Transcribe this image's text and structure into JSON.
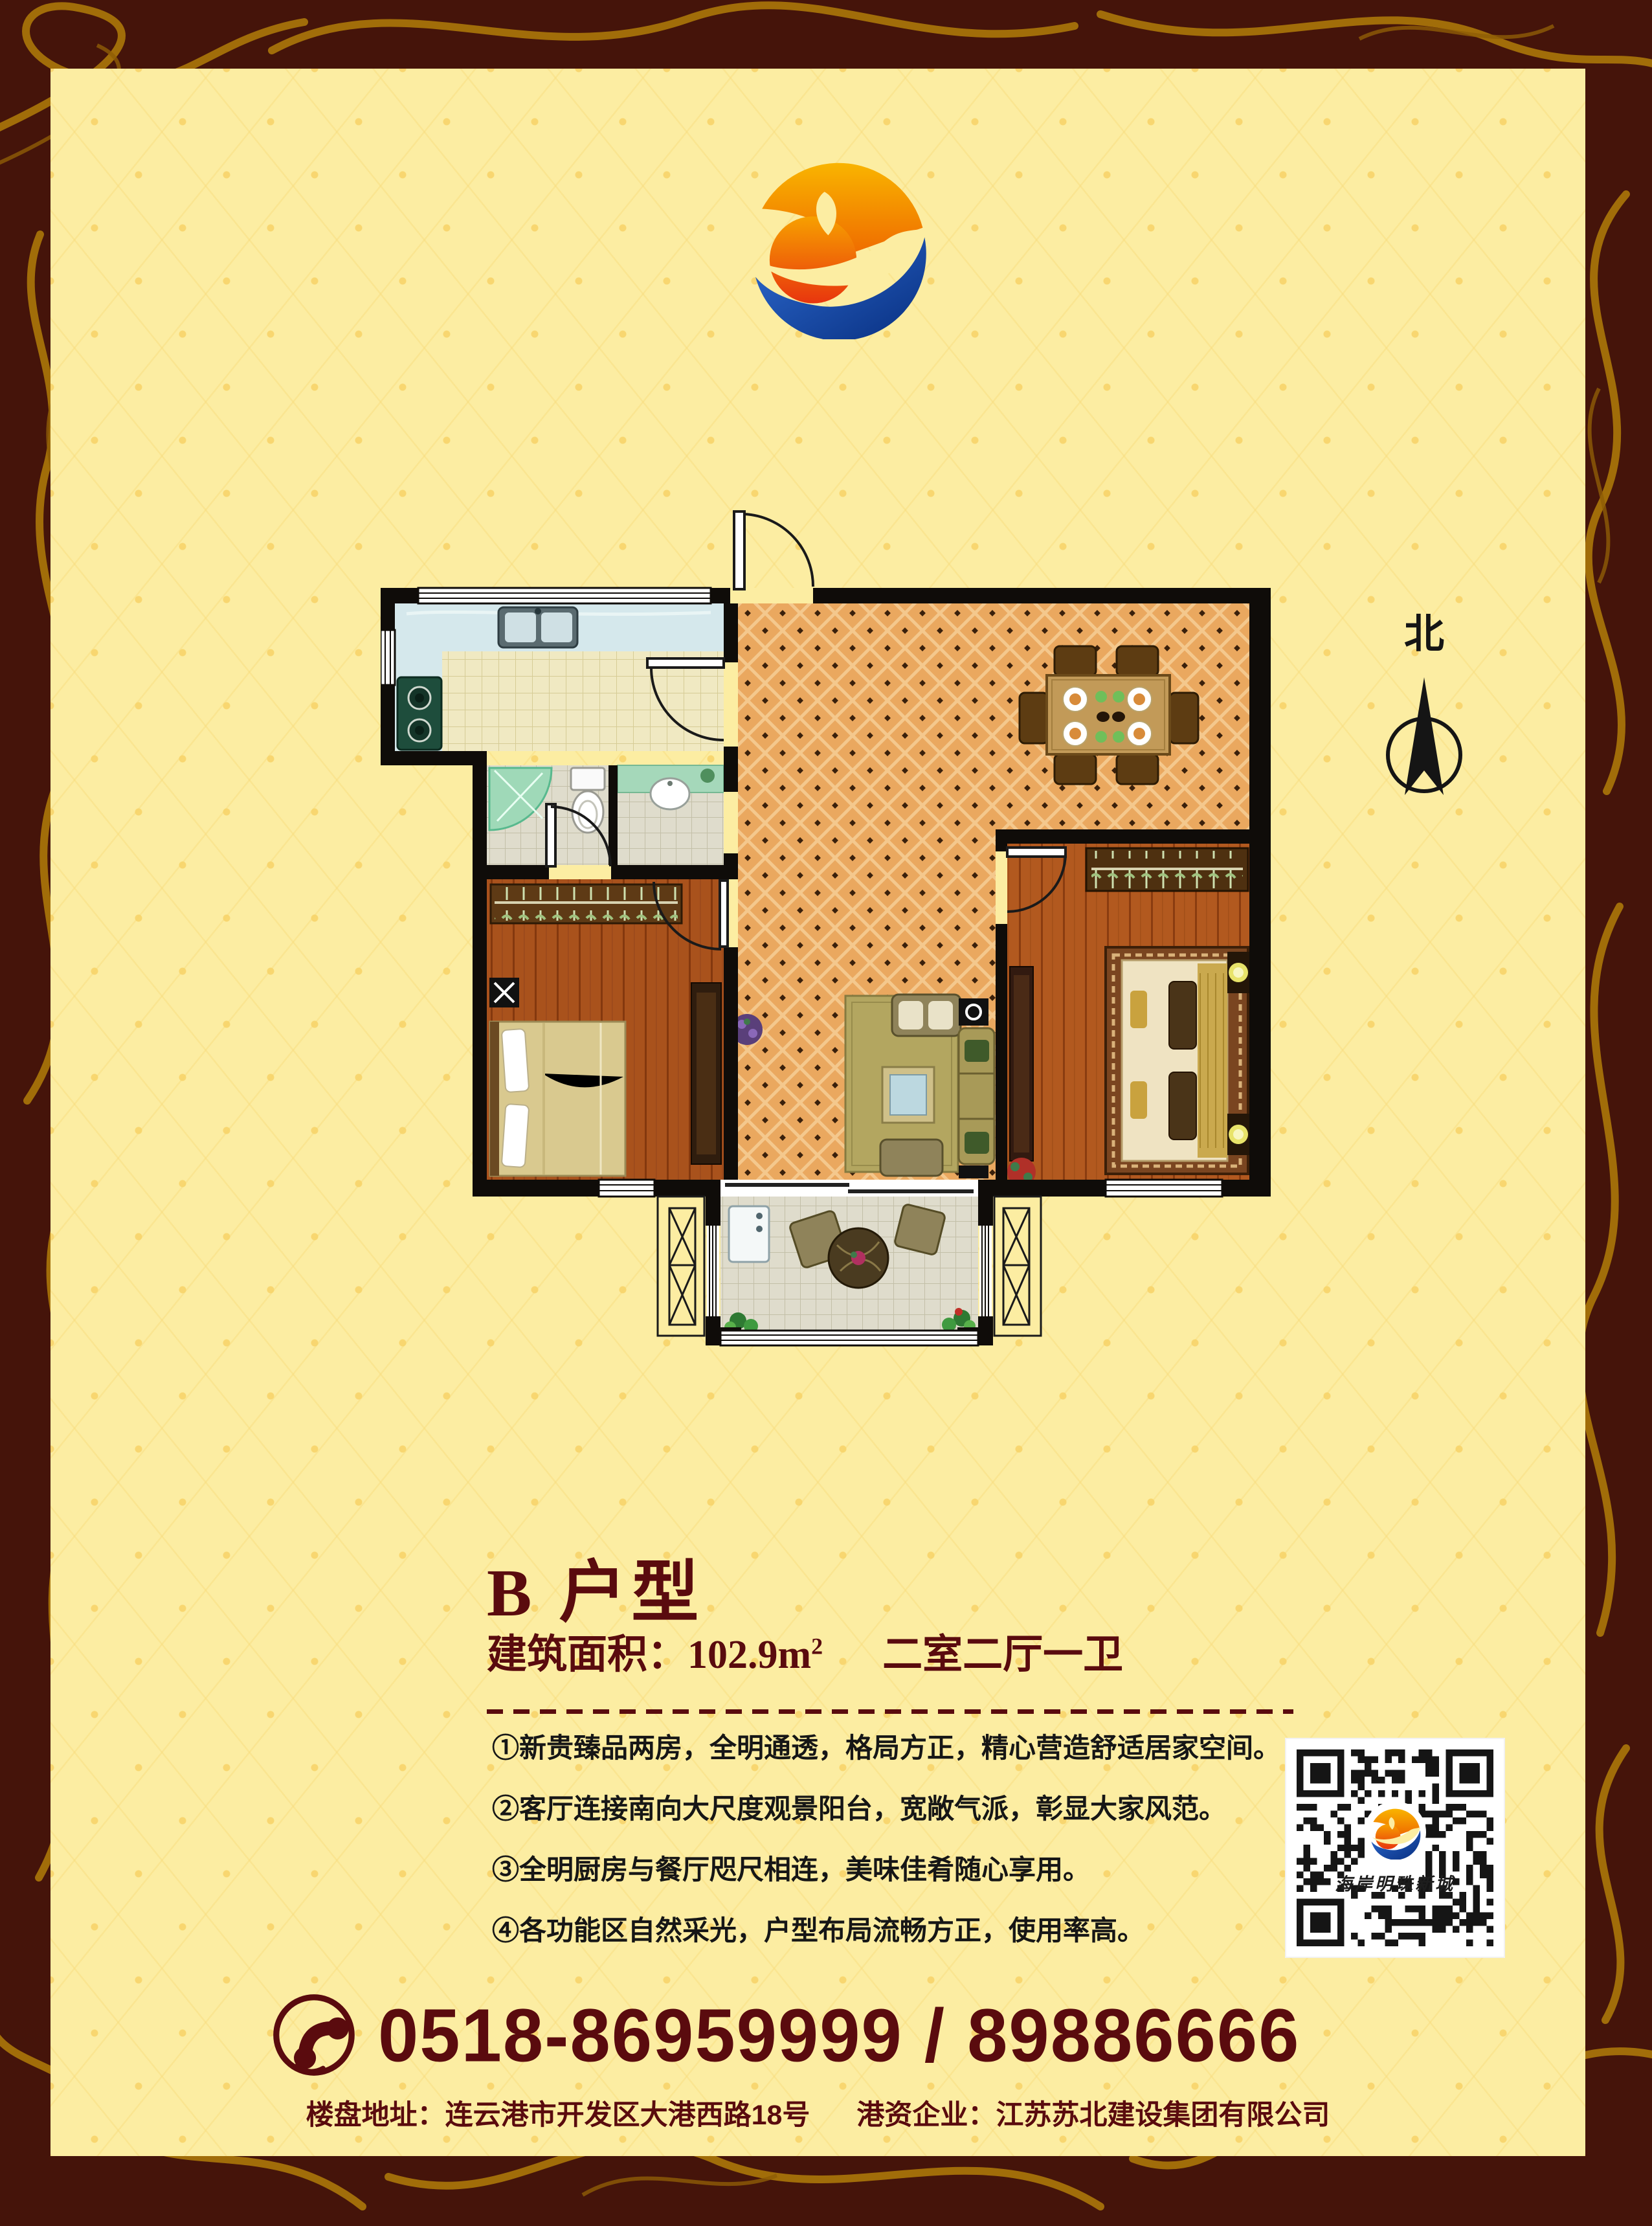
{
  "colors": {
    "frame": "#45140a",
    "frame_gold": "#a6720a",
    "panel_bg": "#fceda2",
    "accent_maroon": "#5a0b0e",
    "text_black": "#161616",
    "plan_wall": "#0f0c09"
  },
  "brand": {
    "logo_icon": "sun-phoenix-wave-logo"
  },
  "compass": {
    "label": "北"
  },
  "unit": {
    "title": "B 户型",
    "area_label": "建筑面积：",
    "area_value": "102.9",
    "area_unit_base": "m",
    "area_unit_exp": "2",
    "layout": "二室二厅一卫"
  },
  "features": [
    "①新贵臻品两房，全明通透，格局方正，精心营造舒适居家空间。",
    "②客厅连接南向大尺度观景阳台，宽敞气派，彰显大家风范。",
    "③全明厨房与餐厅咫尺相连，美味佳肴随心享用。",
    "④各功能区自然采光，户型布局流畅方正，使用率高。"
  ],
  "qr": {
    "caption": "海岸明珠新城"
  },
  "contact": {
    "phone": "0518-86959999 / 89886666",
    "address": "楼盘地址：连云港市开发区大港西路18号",
    "company": "港资企业：江苏苏北建设集团有限公司"
  }
}
